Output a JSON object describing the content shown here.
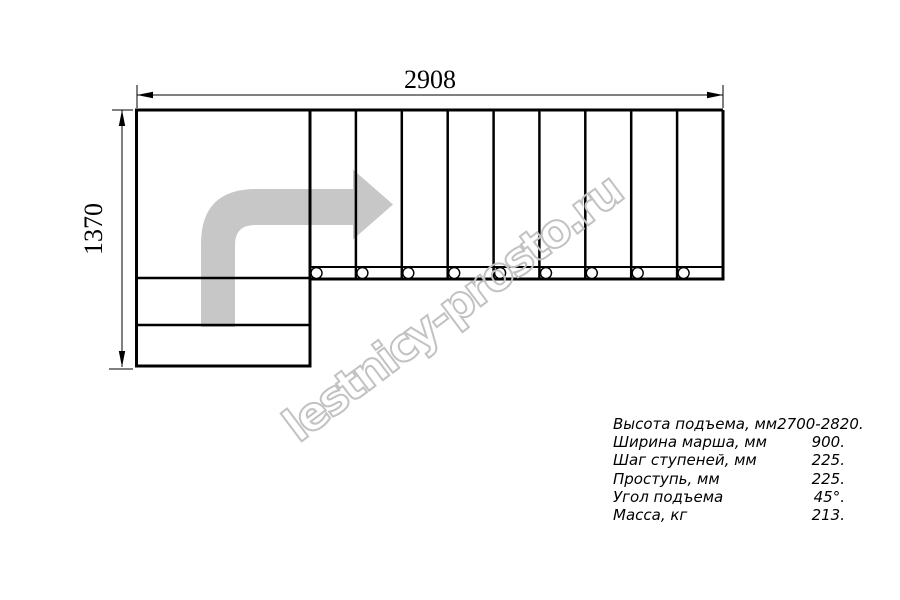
{
  "drawing": {
    "title": "staircase-plan",
    "dimensions": {
      "width_mm": "2908",
      "height_mm": "1370"
    },
    "colors": {
      "line": "#000000",
      "arrow": "#c7c7c7",
      "watermark": "#c2c2c2"
    }
  },
  "watermark": {
    "text": "lestnicy-prosto.ru"
  },
  "specs": [
    {
      "label": "Высота подъема, мм",
      "value": "2700-2820."
    },
    {
      "label": "Ширина марша, мм",
      "value": "900."
    },
    {
      "label": "Шаг ступеней, мм",
      "value": "225."
    },
    {
      "label": "Проступь, мм",
      "value": "225."
    },
    {
      "label": "Угол подъема",
      "value": "45°."
    },
    {
      "label": "Масса, кг",
      "value": "213."
    }
  ]
}
